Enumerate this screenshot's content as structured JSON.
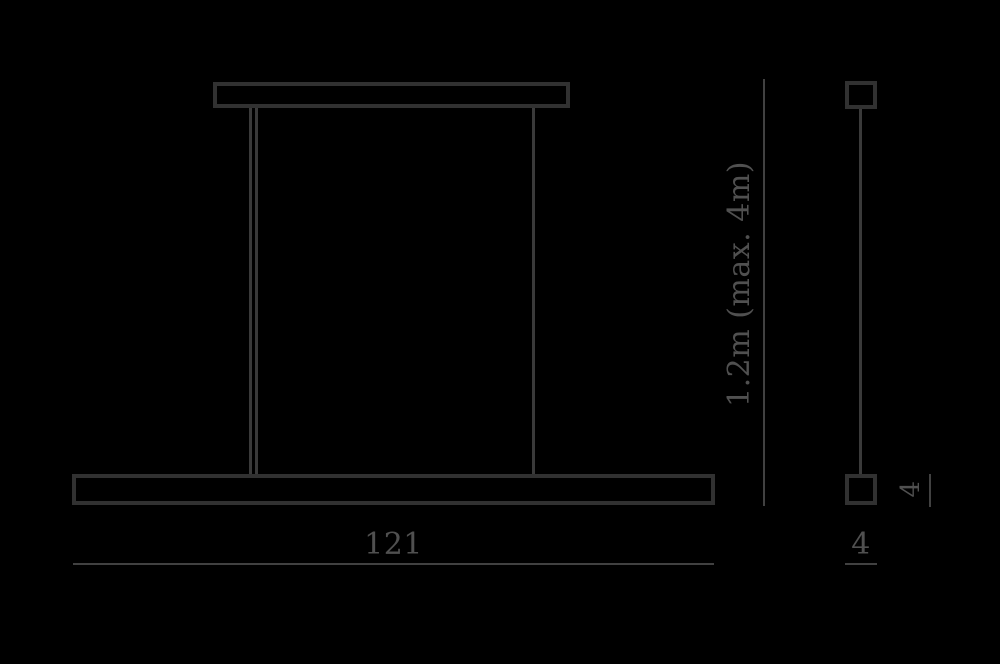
{
  "drawing": {
    "front_view": {
      "width_dimension": "121"
    },
    "height_dimension": {
      "label": "1.2m (max. 4m)"
    },
    "side_view": {
      "height_dimension": "4",
      "width_dimension": "4"
    },
    "colors": {
      "background": "#000000",
      "outline": "#313131",
      "wire": "#3a3a3a",
      "dimension_line": "#414141",
      "text": "#505050"
    }
  }
}
